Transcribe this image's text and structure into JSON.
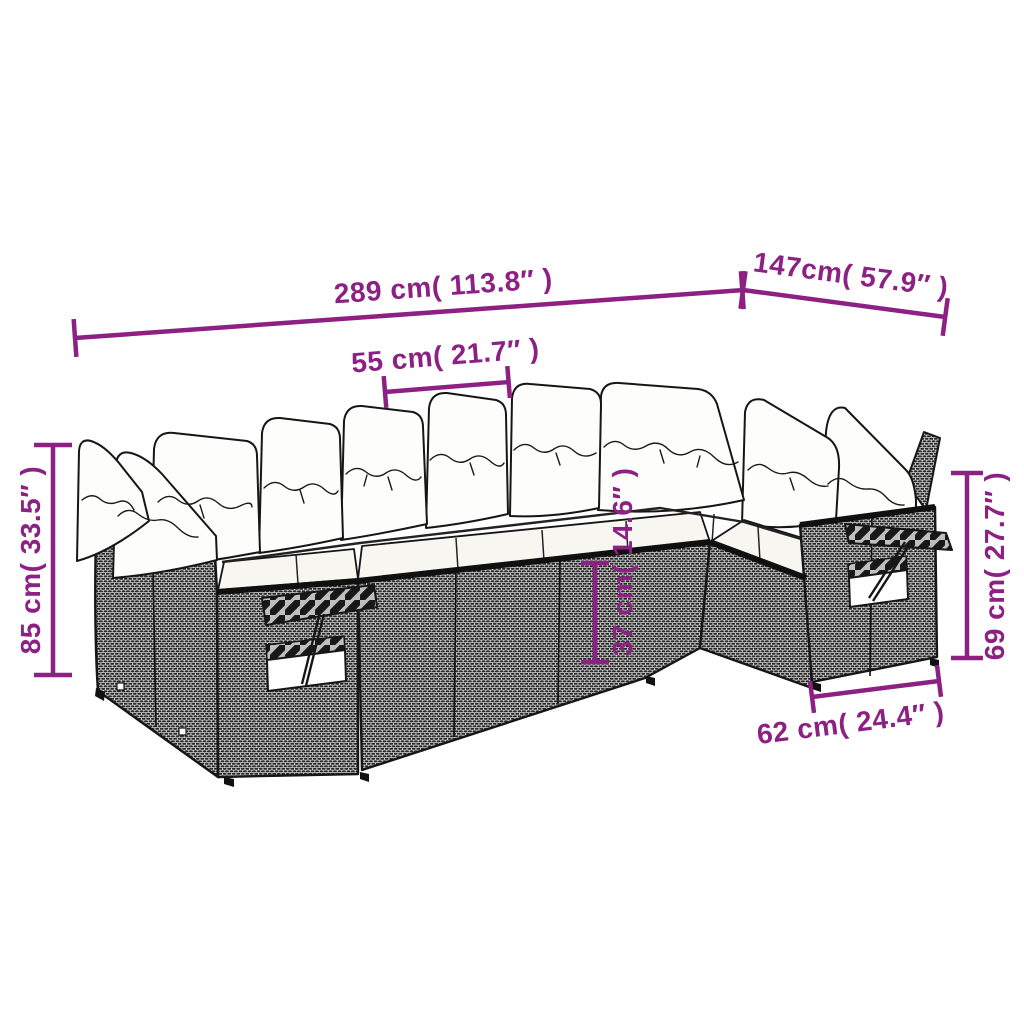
{
  "page": {
    "background": "#ffffff"
  },
  "diagram": {
    "kind": "product-dimension-diagram",
    "subject": "rattan garden corner sofa set with cushions",
    "accent_color": "#8C2083",
    "outline_color": "#161616",
    "dimensions": [
      {
        "id": "total-width",
        "label": "289 cm( 113.8″ )"
      },
      {
        "id": "right-depth",
        "label": "147cm( 57.9″ )"
      },
      {
        "id": "seat-width",
        "label": "55 cm( 21.7″ )"
      },
      {
        "id": "total-height",
        "label": "85 cm( 33.5″ )"
      },
      {
        "id": "arm-height",
        "label": "69 cm( 27.7″ )"
      },
      {
        "id": "seat-height",
        "label": "37 cm( 14.6″ )"
      },
      {
        "id": "end-base-width",
        "label": "62 cm( 24.4″ )"
      }
    ]
  }
}
